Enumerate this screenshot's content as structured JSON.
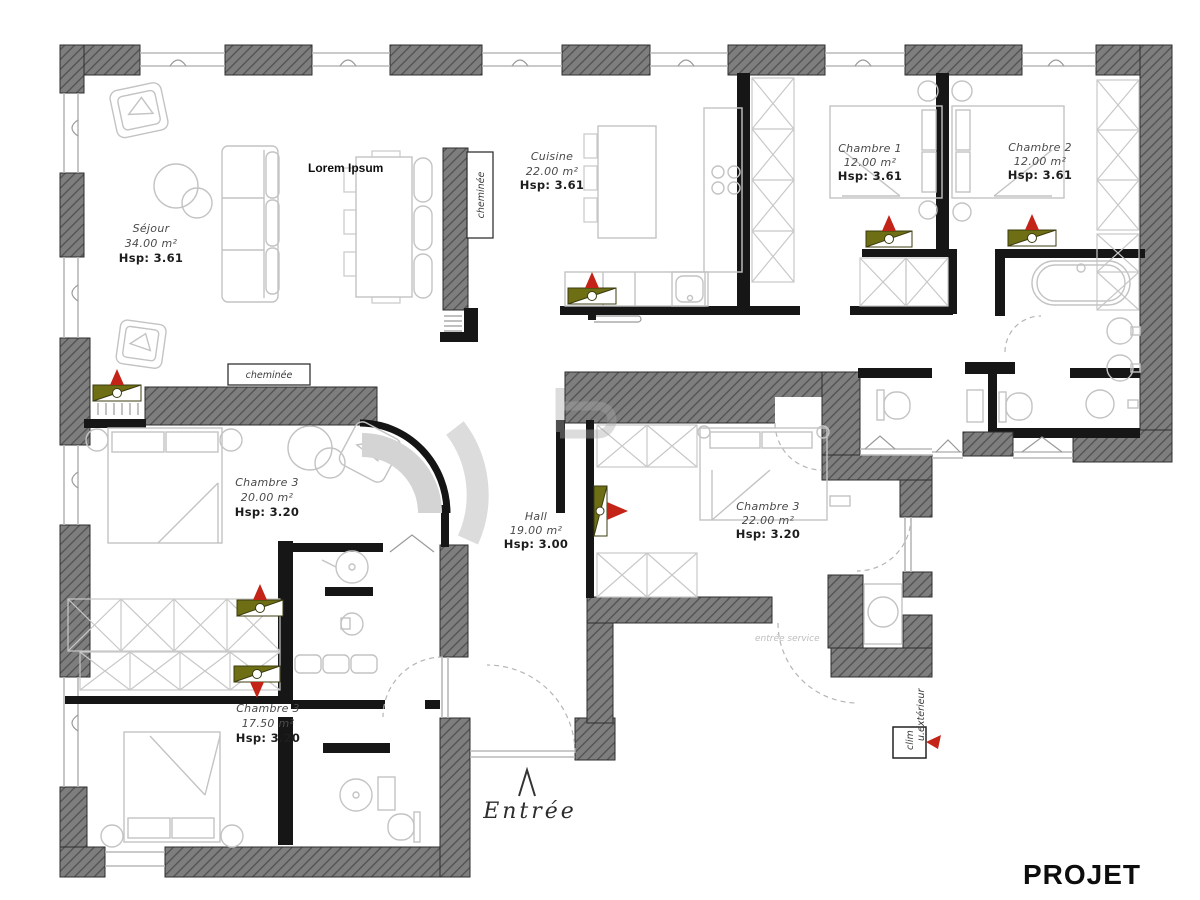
{
  "rooms": {
    "sejour": {
      "name": "Séjour",
      "area": "34.00 m²",
      "hsp": "Hsp: 3.61"
    },
    "cuisine": {
      "name": "Cuisine",
      "area": "22.00 m²",
      "hsp": "Hsp: 3.61"
    },
    "chambre1": {
      "name": "Chambre 1",
      "area": "12.00 m²",
      "hsp": "Hsp: 3.61"
    },
    "chambre2": {
      "name": "Chambre 2",
      "area": "12.00 m²",
      "hsp": "Hsp: 3.61"
    },
    "chambre3_grande": {
      "name": "Chambre 3",
      "area": "20.00 m²",
      "hsp": "Hsp: 3.20"
    },
    "hall": {
      "name": "Hall",
      "area": "19.00 m²",
      "hsp": "Hsp: 3.00"
    },
    "chambre3_est": {
      "name": "Chambre 3",
      "area": "22.00 m²",
      "hsp": "Hsp: 3.20"
    },
    "chambre3_sud": {
      "name": "Chambre 3",
      "area": "17.50 m²",
      "hsp": "Hsp: 3.20"
    }
  },
  "annotations": {
    "lorem_ipsum": "Lorem Ipsum",
    "cheminee_mur": "cheminée",
    "cheminee_sejour": "cheminée",
    "entree": "Entrée",
    "entree_service": "entrée service",
    "clim": "clim",
    "unite_exterieure": "u.extérieur",
    "projet": "PROJET"
  },
  "colors": {
    "wall_gray": "#7e7e7e",
    "wall_hatch": "#515151",
    "interior_wall": "#161616",
    "furniture": "#c3c3c3",
    "radiator_olive": "#6e6e14",
    "marker_red": "#c42418"
  }
}
